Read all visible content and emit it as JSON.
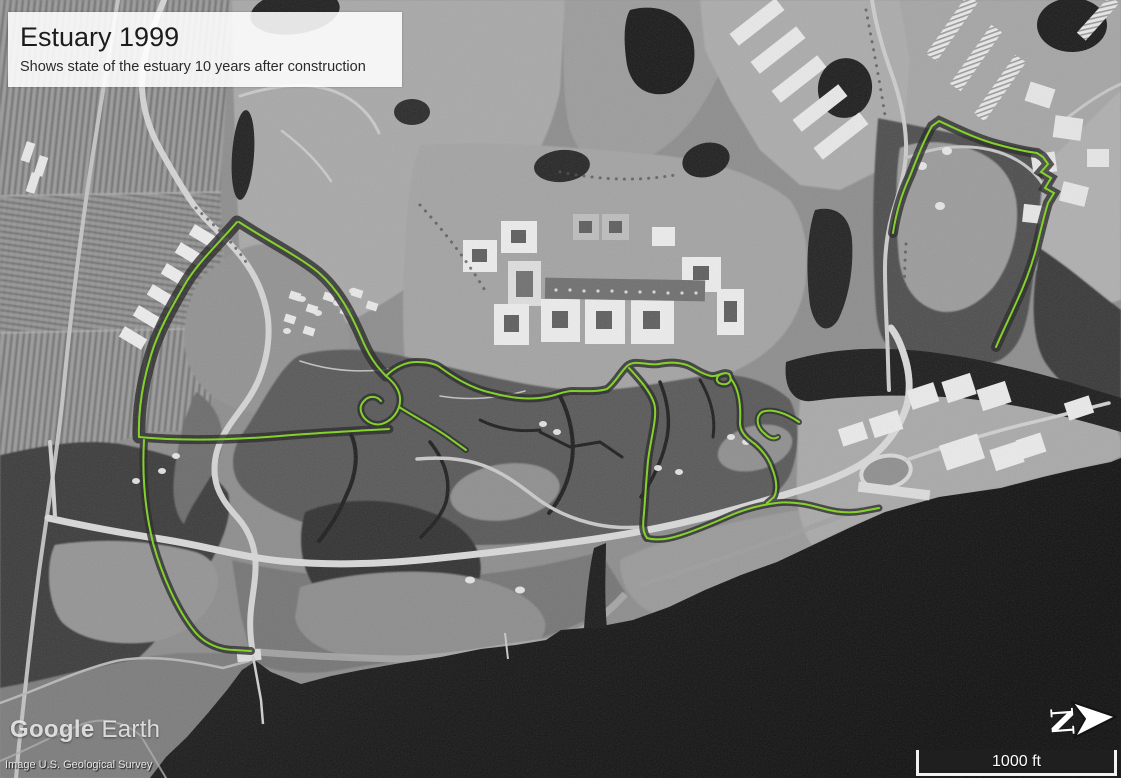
{
  "overlay_card": {
    "title": "Estuary 1999",
    "subtitle": "Shows state of the estuary 10 years after construction"
  },
  "branding": {
    "logo_primary": "Google",
    "logo_secondary": "Earth",
    "attribution": "Image U.S. Geological Survey"
  },
  "controls": {
    "scale_label": "1000 ft",
    "compass_label": "N"
  },
  "annotation": {
    "color": "#7fd41f"
  }
}
